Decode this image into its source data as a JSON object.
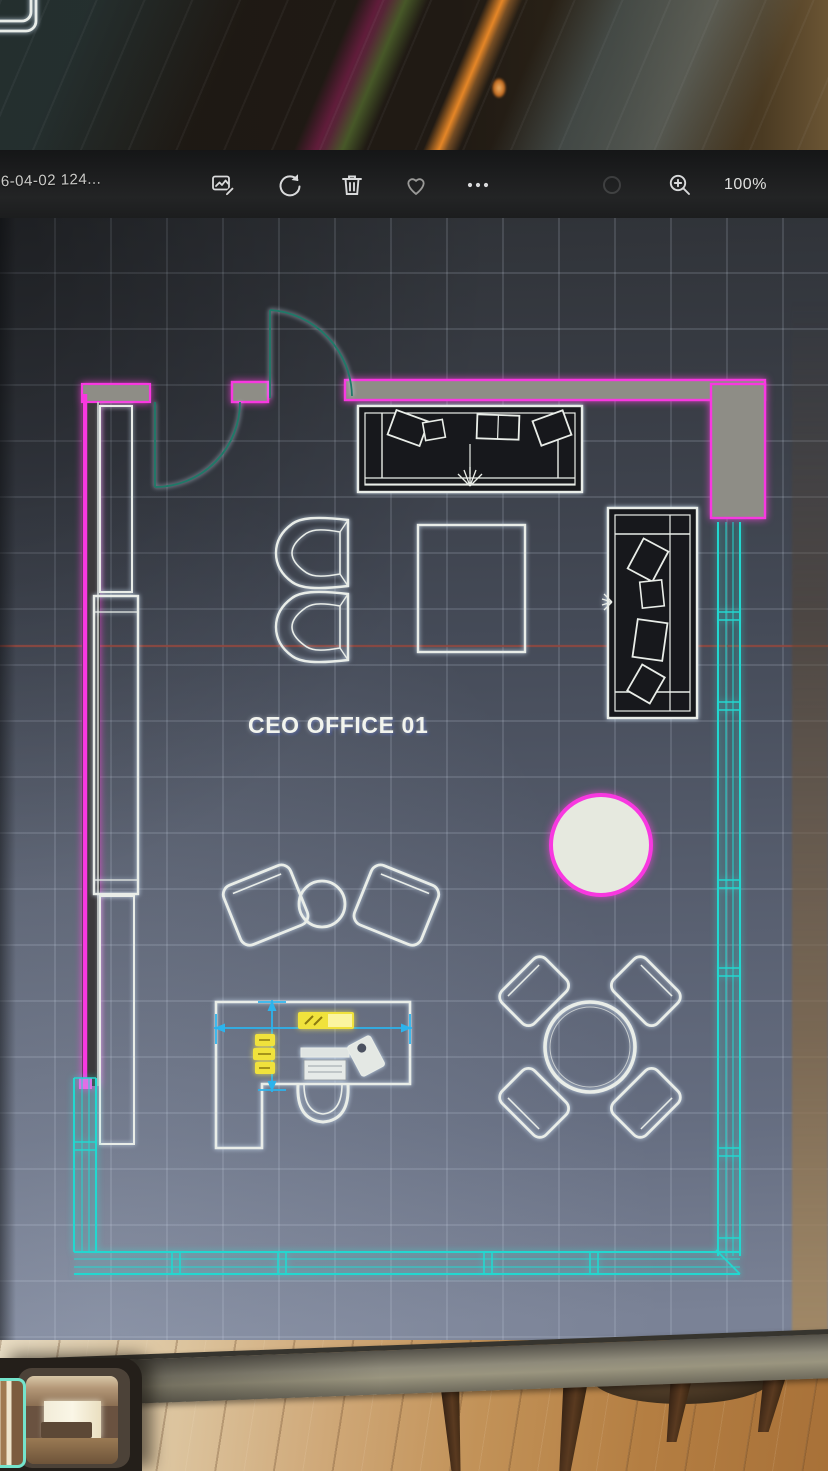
{
  "viewer": {
    "filename": "26-04-02 124...",
    "zoom_level": "100%",
    "toolbar_icons": [
      "edit-image-icon",
      "rotate-icon",
      "trash-icon",
      "heart-icon",
      "ellipsis-icon",
      "zoom-out-dim-icon",
      "zoom-in-icon"
    ]
  },
  "plan": {
    "room_label": "CEO OFFICE 01",
    "colors": {
      "wall_magenta": "#f838e0",
      "curtain_wall_cyan": "#22d8d0",
      "furniture_white": "#e9ede8",
      "door_swing_teal": "#1e7a68",
      "dimension_cyan": "#2cb3ec",
      "dimension_highlight_yellow": "#f0e23c",
      "section_line_red": "#93483f",
      "accent_circle_fill": "#e6e9df"
    },
    "elements": [
      "entry-doors",
      "top-sofa",
      "lounge-chairs",
      "square-table",
      "side-sofa",
      "curtain-wall",
      "accent-rug-circle",
      "guest-chairs-with-side-table",
      "executive-desk",
      "desk-chair",
      "dimension-annotation",
      "round-meeting-table-with-4-chairs",
      "wall-cabinets",
      "section-line"
    ]
  },
  "filmstrip": {
    "thumbnails": [
      {
        "name": "current-cad-drawing",
        "selected": true
      },
      {
        "name": "office-interior-photo",
        "selected": false
      }
    ]
  }
}
